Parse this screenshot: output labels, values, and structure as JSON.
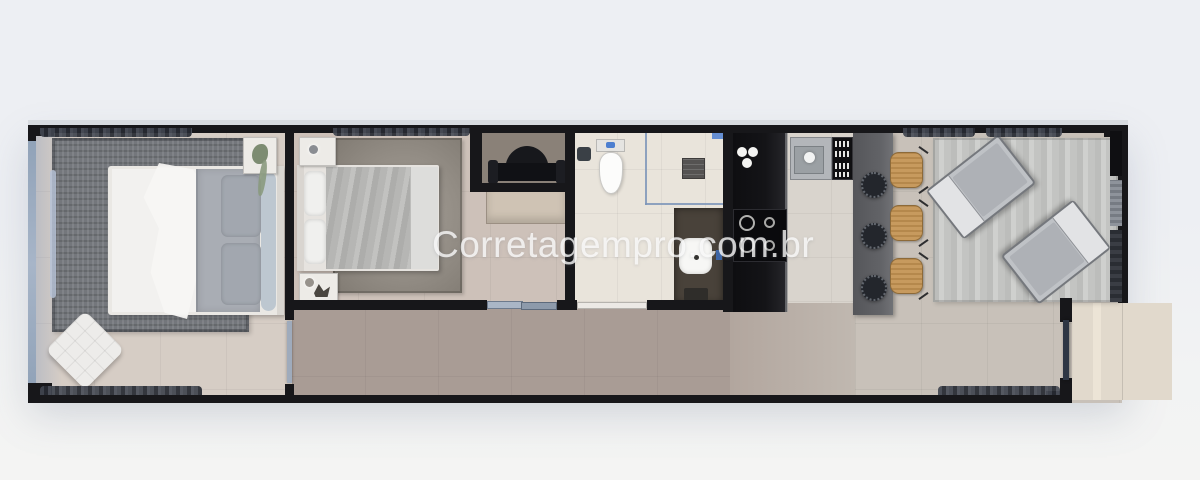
{
  "watermark": {
    "text": "Corretagempro.com.br"
  },
  "palette": {
    "bg-top": "#edeff3",
    "bg-bottom": "#f2f3f3",
    "wall": "#17171a",
    "glass": "#7d95b8",
    "glass-wall": "#93a2b6",
    "floor-bed1": "#d6cdc5",
    "floor-bed2": "#cdc1b9",
    "floor-bath": "#e9e4db",
    "floor-kitchen": "#d9d4cd",
    "floor-living": "#c8c1b9",
    "floor-corridor": "#a99c95",
    "floor-terrace": "#e1d9cc",
    "rug-dark": "#74777c",
    "rug-taupe": "#938d85",
    "rug-light": "#c6c7c5",
    "counter": "#141417",
    "island": "#626367",
    "wicker": "#c79a5e",
    "stool": "#23262c",
    "bed-white": "#f2f1ef",
    "blanket": "#a9adb4",
    "wm": "rgba(252,252,252,0.78)"
  }
}
